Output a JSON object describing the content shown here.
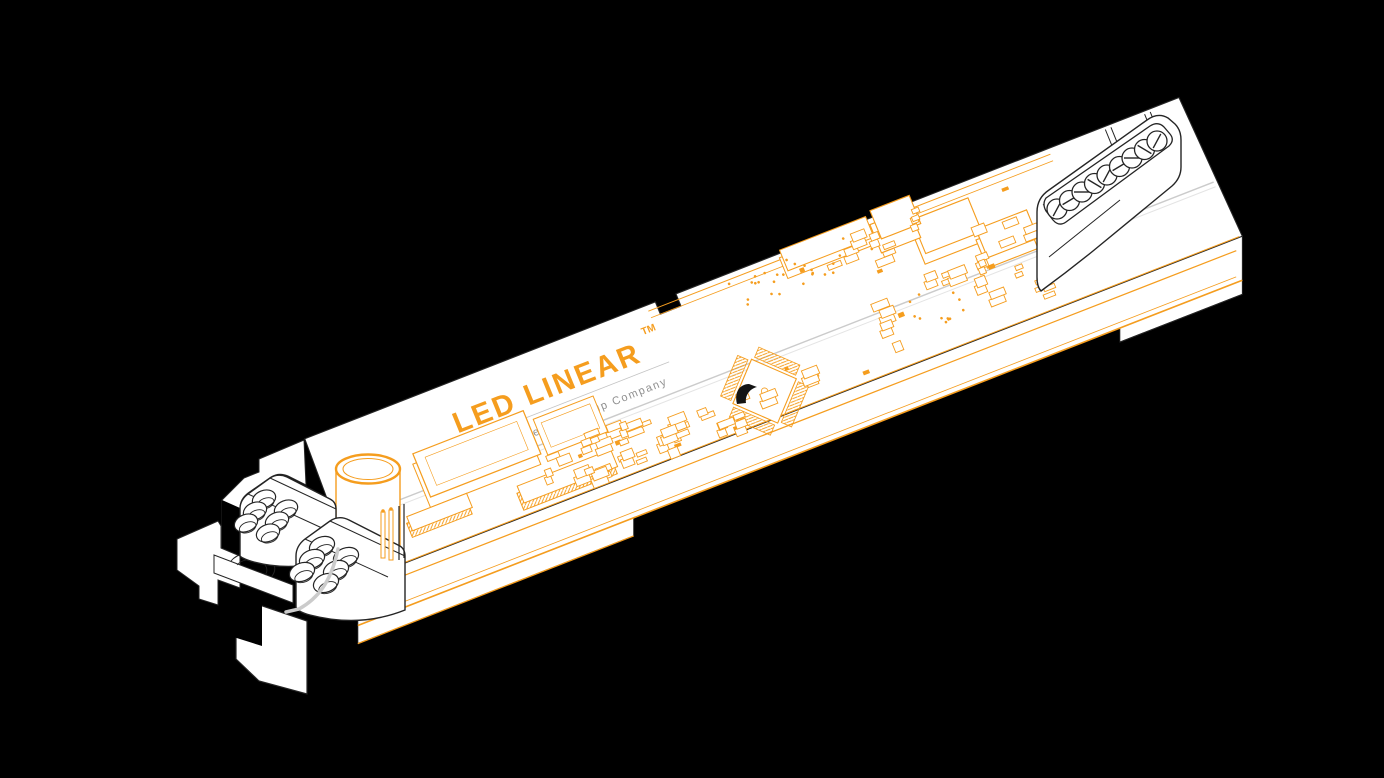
{
  "branding": {
    "brand": "LED LINEAR",
    "trademark": "TM",
    "tagline": "A Fagerhult Group Company"
  },
  "colors": {
    "background": "#000000",
    "accent_orange": "#F59D1E",
    "housing_white": "#FFFFFF",
    "outline_dark": "#252525",
    "outline_gray": "#CBCBCB",
    "tagline_gray": "#8F8F8F"
  },
  "terminals": {
    "left_block_count": 2,
    "left_screws_per_block": 6,
    "right_screw_count": 9
  }
}
